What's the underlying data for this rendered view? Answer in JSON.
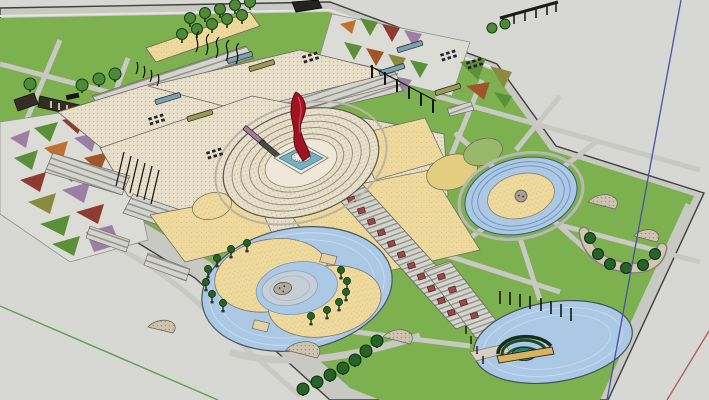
{
  "scene": {
    "kind": "3d-modeling-viewport",
    "objects": [
      "park-model",
      "perimeter-road",
      "lawns",
      "tree-allee",
      "ruin-structure",
      "mosaic-planting-beds",
      "terrace-plaza",
      "planter-boxes",
      "seat-grids",
      "central-fountain-plaza",
      "red-sculpture",
      "reflecting-pool",
      "ring-water-plaza",
      "yinyang-water-plaza",
      "potted-trees",
      "red-planter-stairway",
      "pond",
      "amphitheater-stage",
      "lamp-posts",
      "pergola-posts",
      "pavilion",
      "gravel-patios",
      "tree-cluster",
      "axis-lines"
    ]
  },
  "palette": {
    "bg": "#d7d7d3",
    "edge": "#3f3f3b",
    "road": "#c9c9c3",
    "road_light": "#e6e6e1",
    "road_line": "#90908a",
    "lawn": "#7db04f",
    "lawn_line": "#4a7534",
    "paving_bg": "#e8dfca",
    "paving_dot": "#c4b797",
    "paving_edge": "#6b675c",
    "sand_bg": "#eeda9f",
    "sand_dot": "#dcc478",
    "gravel_bg": "#cdc3b0",
    "gravel_dot": "#968a74",
    "water": "#abc8e4",
    "water_line": "#c9dbee",
    "water_edge": "#46525e",
    "pool": "#74b2c2",
    "pool_curb": "#eceae2",
    "pedestal": "#f4f2ec",
    "sculpture": "#a01323",
    "sculpture_dark": "#4e0810",
    "sculpture_hi": "#d8465a",
    "planter_blue": "#7fa0b0",
    "planter_olive": "#9a9a52",
    "planter_mauve": "#a57a9a",
    "seat": "#21252b",
    "bench_red": "#9c4848",
    "tree": "#4c8a3a",
    "tree_dark": "#1c3a12",
    "tree_deep": "#256326",
    "tree_deep_dark": "#0d2c0e",
    "trunk": "#241709",
    "mosaic_green": "#5c8f3a",
    "mosaic_purple": "#9d7fa5",
    "mosaic_orange": "#c07030",
    "mosaic_darkred": "#8e3b32",
    "mosaic_olive": "#8a8a40",
    "mosaic_rust": "#a2542a",
    "steps_bg": "#d4d4ce",
    "steps_line": "#93938b",
    "amphi1": "#123018",
    "amphi2": "#1d4a24",
    "amphi3": "#2a5e30",
    "stage": "#d9b25e",
    "dome": "#2f7d7d",
    "post": "#151515",
    "inner_disc": "#c6cfd8",
    "inner_disc_line": "#8fa3b5",
    "medallion": "#b2aa9a",
    "quarter_yellow": "#e3cd7e",
    "quarter_green": "#9ab86a",
    "ruin": "#342d24",
    "ruin_dark": "#14100a",
    "axis_green": "#5fa052",
    "axis_blue": "#4f4fa8",
    "axis_red": "#b25a52"
  }
}
